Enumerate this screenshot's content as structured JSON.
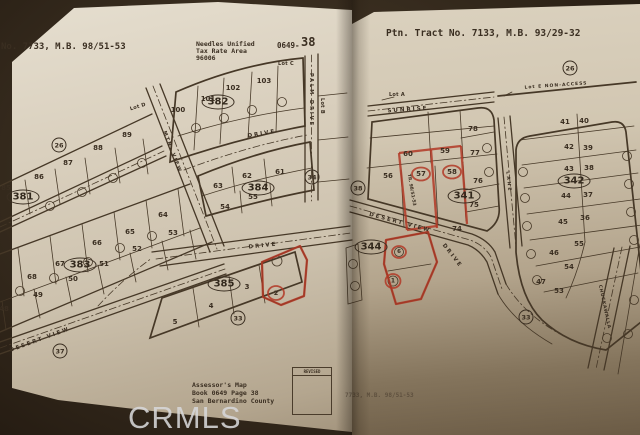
{
  "watermark": "CRMLS",
  "colors": {
    "paper": "#d6cbb8",
    "ink": "#463827",
    "red_annotation": "#b23826",
    "background": "#352a1d",
    "watermark_gray": "#d7d7d9"
  },
  "left_page": {
    "header": {
      "tract_no": "No. 7733, M.B. 98/51-53",
      "district_line1": "Needles Unified",
      "district_line2": "Tax Rate Area",
      "district_line3": "96006",
      "book_prefix": "0649-",
      "sheet_number": "38"
    },
    "footer": {
      "title": "Assessor's Map",
      "book_line": "Book 0649 Page 38",
      "county_line": "San Bernardino County",
      "revised_label": "REVISED"
    },
    "block_labels": {
      "b381": "381",
      "b382": "382",
      "b383": "383",
      "b384": "384",
      "b385": "385"
    },
    "ref_circles": {
      "r26": "26",
      "r33": "33",
      "r34": "34",
      "r37": "37"
    },
    "lot_labels": {
      "lot_b": "Lot B",
      "lot_c": "Lot C",
      "lot_d": "Lot D"
    },
    "street_labels": {
      "palm_drive": "PALM DRIVE",
      "drive_upper": "DRIVE",
      "drive_lower": "DRIVE",
      "desert_view": "DESERT VIEW",
      "mtn_view": "MTN. VIEW"
    },
    "parcels": {
      "block_382": [
        "100",
        "101",
        "102",
        "103"
      ],
      "block_381": [
        "85",
        "86",
        "87",
        "88",
        "89"
      ],
      "block_383_north": [
        "68",
        "67",
        "66",
        "65",
        "64"
      ],
      "block_383_south": [
        "48",
        "49",
        "50",
        "51",
        "52",
        "53"
      ],
      "block_384_north": [
        "63",
        "62",
        "61"
      ],
      "block_384_south": [
        "54",
        "55"
      ],
      "block_385": [
        "5",
        "4",
        "3"
      ],
      "red_parcel": "2"
    }
  },
  "right_page": {
    "header": {
      "tract_no": "Ptn. Tract No. 7133, M.B. 93/29-32"
    },
    "block_labels": {
      "b341": "341",
      "b342": "342",
      "b344": "344"
    },
    "ref_circles": {
      "r26": "26",
      "r33": "33",
      "r38": "38"
    },
    "lot_labels": {
      "lot_a": "Lot A",
      "lot_e": "Lot E NON-ACCESS"
    },
    "street_labels": {
      "sunrise": "SUNRISE",
      "desert_view": "DESERT VIEW",
      "drive": "DRIVE",
      "lane": "LANE",
      "chuckawalla": "CHUCKAWALLA",
      "tract_ref": "TR. 98/51-53"
    },
    "parcels": {
      "north_block_row1": [
        "60",
        "59",
        "78",
        "77"
      ],
      "north_block_row2": [
        "56",
        "57",
        "58",
        "76",
        "75",
        "74"
      ],
      "block_342_west": [
        "41",
        "42",
        "43",
        "44",
        "45"
      ],
      "block_342_east": [
        "40",
        "39",
        "38",
        "37",
        "36"
      ],
      "block_342_south": [
        "55",
        "46",
        "54",
        "47",
        "53"
      ],
      "block_344": [
        "6",
        "1"
      ]
    },
    "fold_note": "7733, M.B. 98/51-53"
  }
}
